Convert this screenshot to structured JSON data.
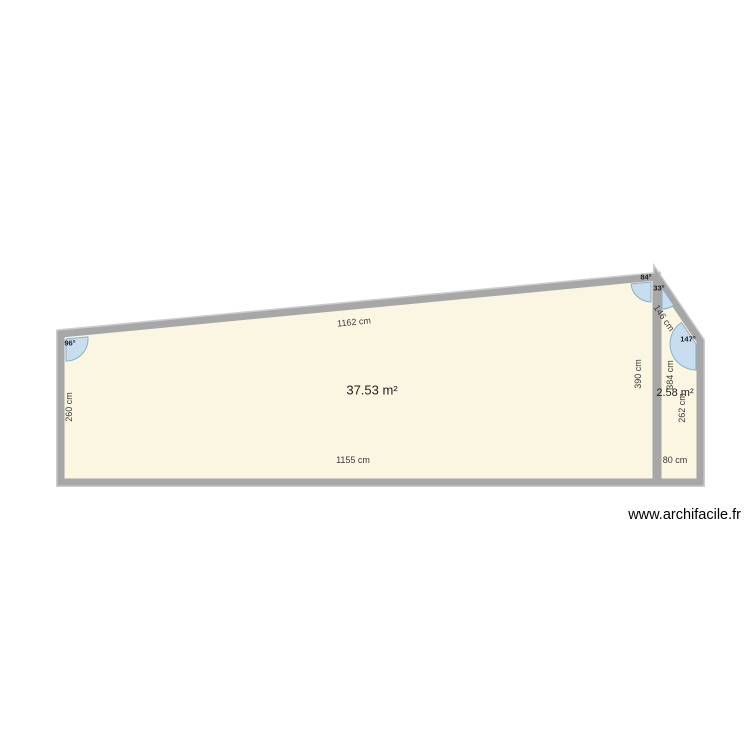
{
  "page": {
    "watermark": {
      "text": "www.archifacile.fr",
      "x": 741,
      "y": 519
    }
  },
  "colors": {
    "page_bg": "#FFFFFF",
    "room_fill": "#FAF6E1",
    "wall_core": "#A7A7A7",
    "wall_edge": "#CDCDCD",
    "angle_fill": "#C8DEEF",
    "angle_stroke": "#8AAFC9",
    "dimension_text": "#3C3C3C",
    "area_text": "#1F1F1F",
    "watermark_text": "#000000"
  },
  "floorplan": {
    "rooms": [
      {
        "area": "37.53 m²",
        "points": "61,334 656,277 656,482 61,482",
        "label": {
          "x": 372,
          "y": 390
        }
      },
      {
        "area": "2.58 m²",
        "points": "658,279 700,341 700,482 658,482",
        "label": {
          "x": 675,
          "y": 393
        }
      }
    ],
    "dimensions": [
      {
        "text": "1162 cm",
        "x": 354,
        "y": 322,
        "transform": "rotate(-5.5 354 322)"
      },
      {
        "text": "260 cm",
        "x": 69,
        "y": 407,
        "transform": "rotate(-90 69 407)"
      },
      {
        "text": "1155 cm",
        "x": 353,
        "y": 460,
        "transform": ""
      },
      {
        "text": "390 cm",
        "x": 638,
        "y": 374,
        "transform": "rotate(-90 638 374)"
      },
      {
        "text": "146 cm",
        "x": 664,
        "y": 318,
        "transform": "rotate(56 664 318)"
      },
      {
        "text": "384 cm",
        "x": 670,
        "y": 375,
        "transform": "rotate(-90 670 375)"
      },
      {
        "text": "262 cm",
        "x": 682,
        "y": 408,
        "transform": "rotate(-90 682 408)"
      },
      {
        "text": "80 cm",
        "x": 675,
        "y": 460,
        "transform": ""
      }
    ],
    "angles": [
      {
        "text": "96°",
        "wedge": "M 66 339 L 66 361 A 22 22 0 0 0 87.9 336.9 Z",
        "x": 70,
        "y": 343
      },
      {
        "text": "84°",
        "wedge": "M 651 282 L 631.1 283.9 A 20 20 0 0 0 651 302 Z",
        "x": 646,
        "y": 277
      },
      {
        "text": "33°",
        "wedge": "M 662 288 L 673.8 305.4 A 21 21 0 0 1 662 309 Z",
        "x": 659,
        "y": 288
      },
      {
        "text": "147°",
        "wedge": "M 696 344 L 696 370 A 26 26 0 0 1 681.4 322.5 Z",
        "x": 688,
        "y": 339
      }
    ]
  }
}
